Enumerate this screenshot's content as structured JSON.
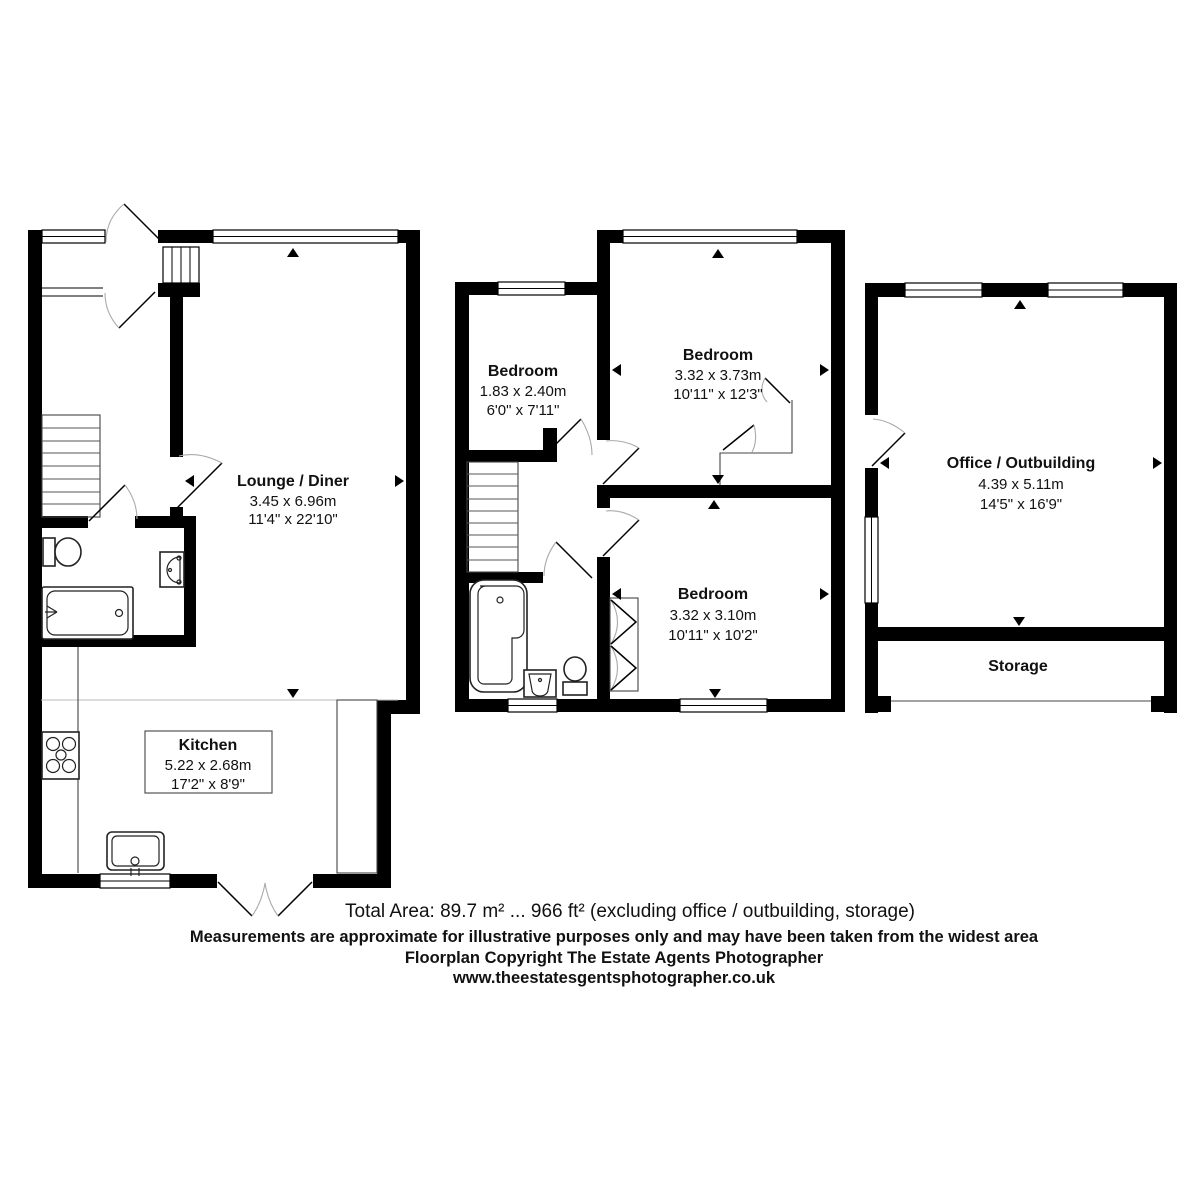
{
  "page": {
    "background": "#ffffff"
  },
  "floorplan": {
    "rooms": {
      "lounge": {
        "name": "Lounge / Diner",
        "metric": "3.45 x 6.96m",
        "imperial": "11'4\" x 22'10\""
      },
      "kitchen": {
        "name": "Kitchen",
        "metric": "5.22 x 2.68m",
        "imperial": "17'2\" x 8'9\""
      },
      "bedroom1": {
        "name": "Bedroom",
        "metric": "1.83 x 2.40m",
        "imperial": "6'0\" x 7'11\""
      },
      "bedroom2": {
        "name": "Bedroom",
        "metric": "3.32 x 3.73m",
        "imperial": "10'11\" x 12'3\""
      },
      "bedroom3": {
        "name": "Bedroom",
        "metric": "3.32 x 3.10m",
        "imperial": "10'11\" x 10'2\""
      },
      "office": {
        "name": "Office / Outbuilding",
        "metric": "4.39 x 5.11m",
        "imperial": "14'5\" x 16'9\""
      },
      "storage": {
        "name": "Storage"
      }
    },
    "footer": {
      "total_area": "Total Area: 89.7 m² ... 966 ft² (excluding office / outbuilding, storage)",
      "disclaimer": "Measurements are approximate for illustrative purposes only and may have been taken from the widest area",
      "copyright": "Floorplan Copyright The Estate Agents Photographer",
      "website": "www.theestatesgentsphotographer.co.uk"
    },
    "colors": {
      "wall": "#000000",
      "background": "#ffffff",
      "door_arc": "#aaaaaa",
      "fixture_outline": "#222222"
    }
  }
}
